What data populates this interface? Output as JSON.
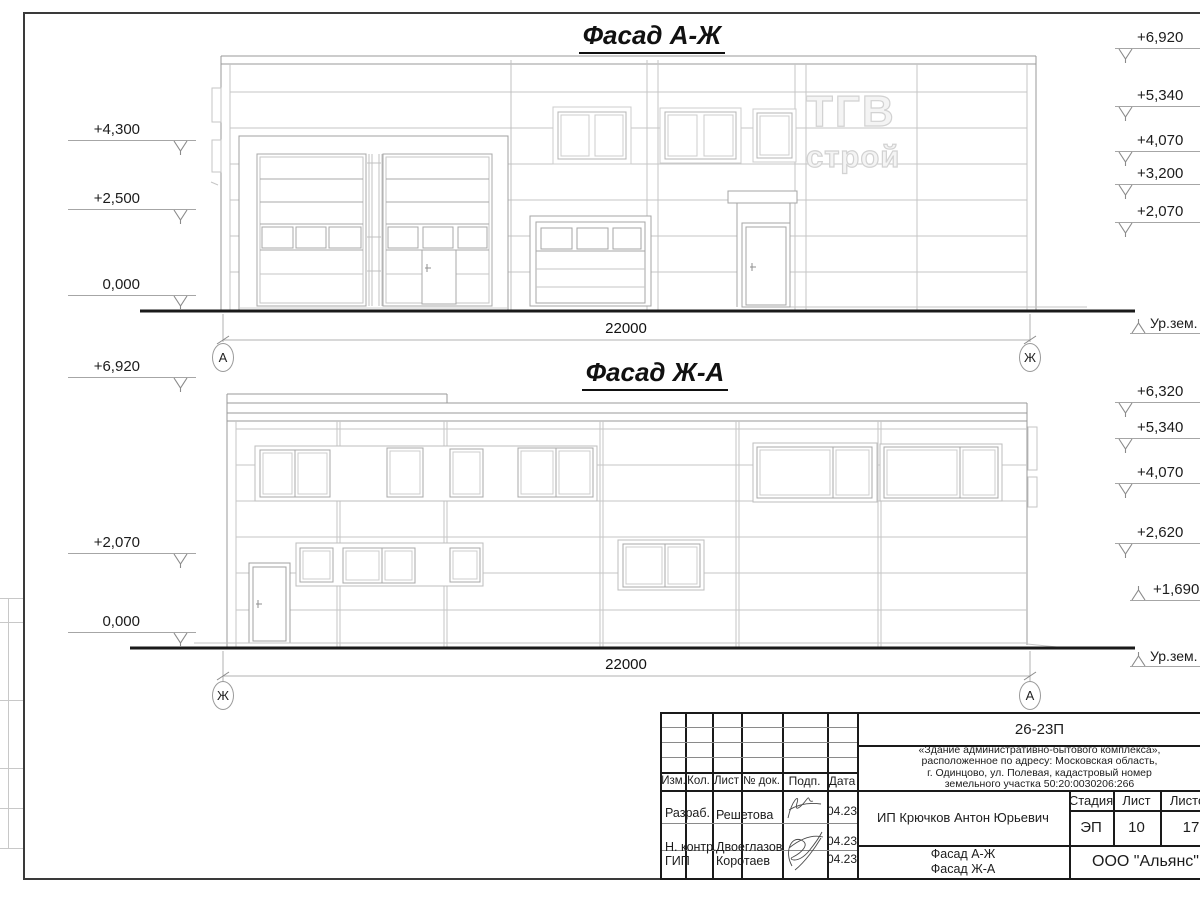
{
  "sheet": {
    "facade1": {
      "title": "Фасад А-Ж",
      "dimension": "22000",
      "axis_left": "А",
      "axis_right": "Ж",
      "marks_left": [
        "+4,300",
        "+2,500",
        "0,000"
      ],
      "marks_right": [
        "+6,920",
        "+5,340",
        "+4,070",
        "+3,200",
        "+2,070"
      ],
      "ground_label": "Ур.зем."
    },
    "facade2": {
      "title": "Фасад Ж-А",
      "dimension": "22000",
      "axis_left": "Ж",
      "axis_right": "А",
      "marks_left": [
        "+6,920",
        "+2,070",
        "0,000"
      ],
      "marks_right": [
        "+6,320",
        "+5,340",
        "+4,070",
        "+2,620"
      ],
      "mark_up": "+1,690",
      "ground_label": "Ур.зем."
    },
    "watermark": {
      "line1": "ТГВ",
      "line2": "строй"
    },
    "titleblock": {
      "doc_number": "26-23П",
      "project": [
        "«Здание административно-бытового комплекса»,",
        "расположенное по адресу: Московская область,",
        "г. Одинцово, ул. Полевая, кадастровый номер",
        "земельного участка 50:20:0030206:266"
      ],
      "columns": [
        "Изм.",
        "Кол.",
        "Лист",
        "№ док.",
        "Подп.",
        "Дата"
      ],
      "rows": [
        {
          "role": "Разраб.",
          "name": "Решетова",
          "date": "04.23"
        },
        {
          "role": "Н. контр.",
          "name": "Двоеглазов",
          "date": "04.23"
        },
        {
          "role": "ГИП",
          "name": "Коротаев",
          "date": "04.23"
        }
      ],
      "client": "ИП Крючков Антон Юрьевич",
      "stage_label": "Стадия",
      "sheet_label": "Лист",
      "sheets_label": "Листов",
      "stage": "ЭП",
      "sheet_number": "10",
      "sheets_total": "17",
      "subject": [
        "Фасад А-Ж",
        "Фасад Ж-А"
      ],
      "company": "ООО \"Альянс\""
    }
  }
}
